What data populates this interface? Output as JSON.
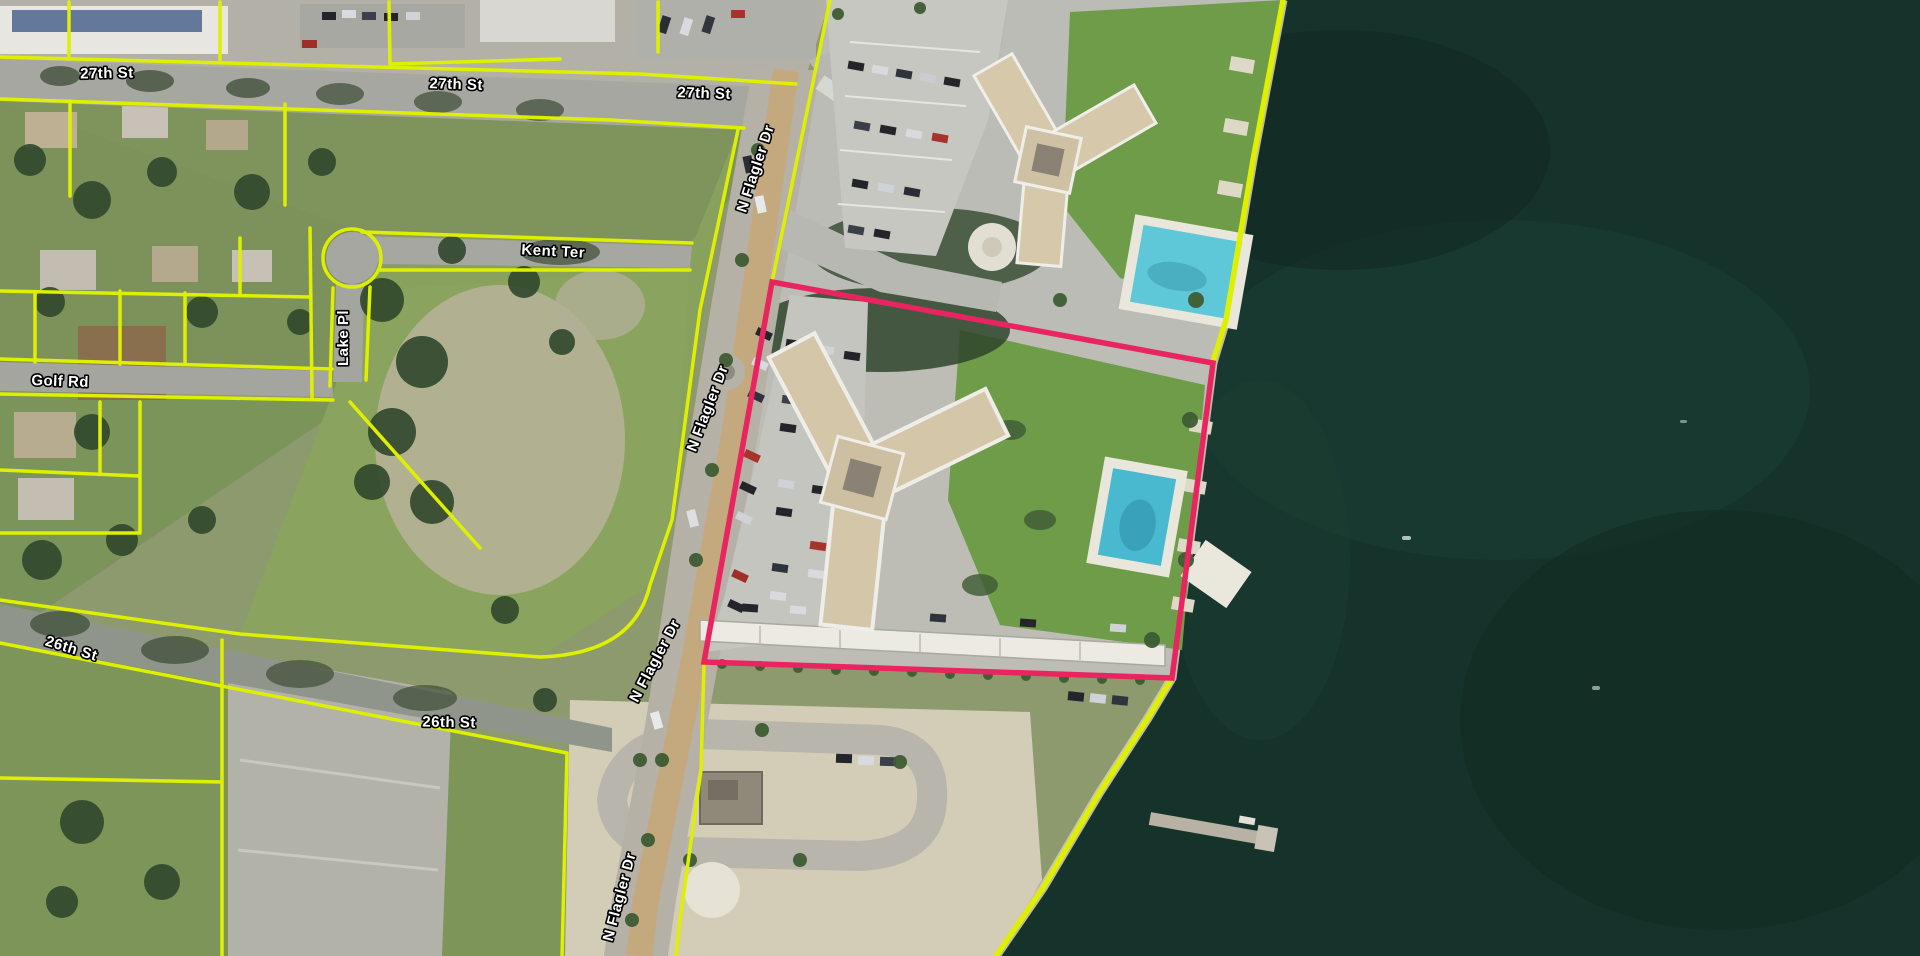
{
  "map": {
    "street_labels": [
      {
        "text": "27th St"
      },
      {
        "text": "27th St"
      },
      {
        "text": "27th St"
      },
      {
        "text": "N Flagler Dr"
      },
      {
        "text": "Kent Ter"
      },
      {
        "text": "Lake Pl"
      },
      {
        "text": "Golf Rd"
      },
      {
        "text": "N Flagler Dr"
      },
      {
        "text": "26th St"
      },
      {
        "text": "26th St"
      },
      {
        "text": "N Flagler Dr"
      },
      {
        "text": "N Flagler Dr"
      }
    ],
    "selected_parcel": {
      "boundary_color": "#e82560"
    },
    "parcel_lines": {
      "color": "#def000"
    },
    "water_color": "#16332b",
    "labels_style": {
      "text_color": "#ffffff",
      "halo_color": "#000000"
    }
  }
}
